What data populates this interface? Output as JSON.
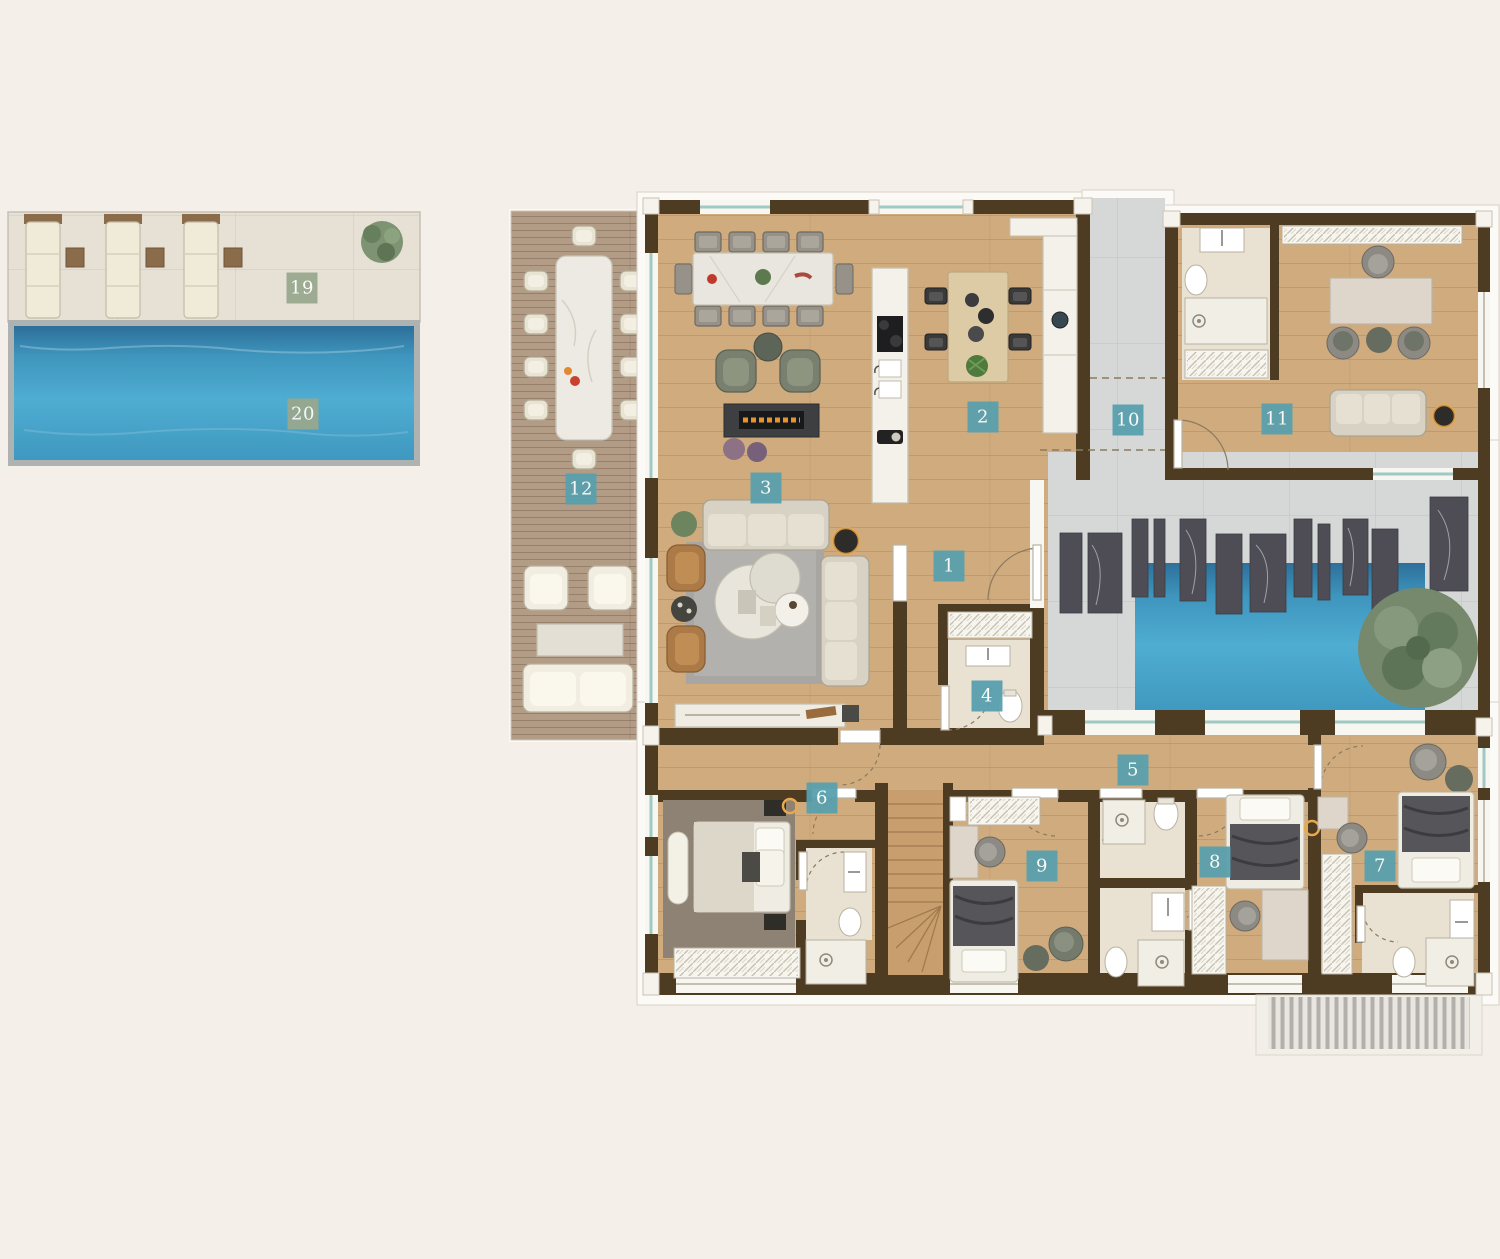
{
  "meta": {
    "view": "architectural-floor-plan-top-view",
    "scene": "penthouse floor plan with outdoor pool deck, terrace and inner courtyard water feature"
  },
  "canvas": {
    "width": 1500,
    "height": 1259,
    "background": "#f5efe9"
  },
  "palette": {
    "wall": "#4d3b22",
    "wood_floor": "#d0ab7e",
    "terrace_deck": "#b39c85",
    "stone_deck": "#e6e0d5",
    "tile_floor": "#d5d8d7",
    "bath_floor": "#e9e2d2",
    "pool_water": "#44a0c4",
    "pool_water_dark": "#2d6f9a",
    "marble_slab": "#4e4d56",
    "glass_window": "#9fc9c5",
    "label_teal": "#58a0ae",
    "label_sage": "#99a88e",
    "label_text": "#fdfdfa"
  },
  "labels": [
    {
      "number": "1",
      "style": "teal",
      "x": 949,
      "y": 566
    },
    {
      "number": "2",
      "style": "teal",
      "x": 983,
      "y": 417
    },
    {
      "number": "3",
      "style": "teal",
      "x": 766,
      "y": 488
    },
    {
      "number": "4",
      "style": "teal",
      "x": 987,
      "y": 696
    },
    {
      "number": "5",
      "style": "teal",
      "x": 1133,
      "y": 770
    },
    {
      "number": "6",
      "style": "teal",
      "x": 822,
      "y": 798
    },
    {
      "number": "7",
      "style": "teal",
      "x": 1380,
      "y": 866
    },
    {
      "number": "8",
      "style": "teal",
      "x": 1215,
      "y": 862
    },
    {
      "number": "9",
      "style": "teal",
      "x": 1042,
      "y": 866
    },
    {
      "number": "10",
      "style": "teal",
      "x": 1128,
      "y": 420
    },
    {
      "number": "11",
      "style": "teal",
      "x": 1277,
      "y": 419
    },
    {
      "number": "12",
      "style": "teal",
      "x": 581,
      "y": 489
    },
    {
      "number": "19",
      "style": "sage",
      "x": 302,
      "y": 288
    },
    {
      "number": "20",
      "style": "sage",
      "x": 303,
      "y": 414
    }
  ]
}
